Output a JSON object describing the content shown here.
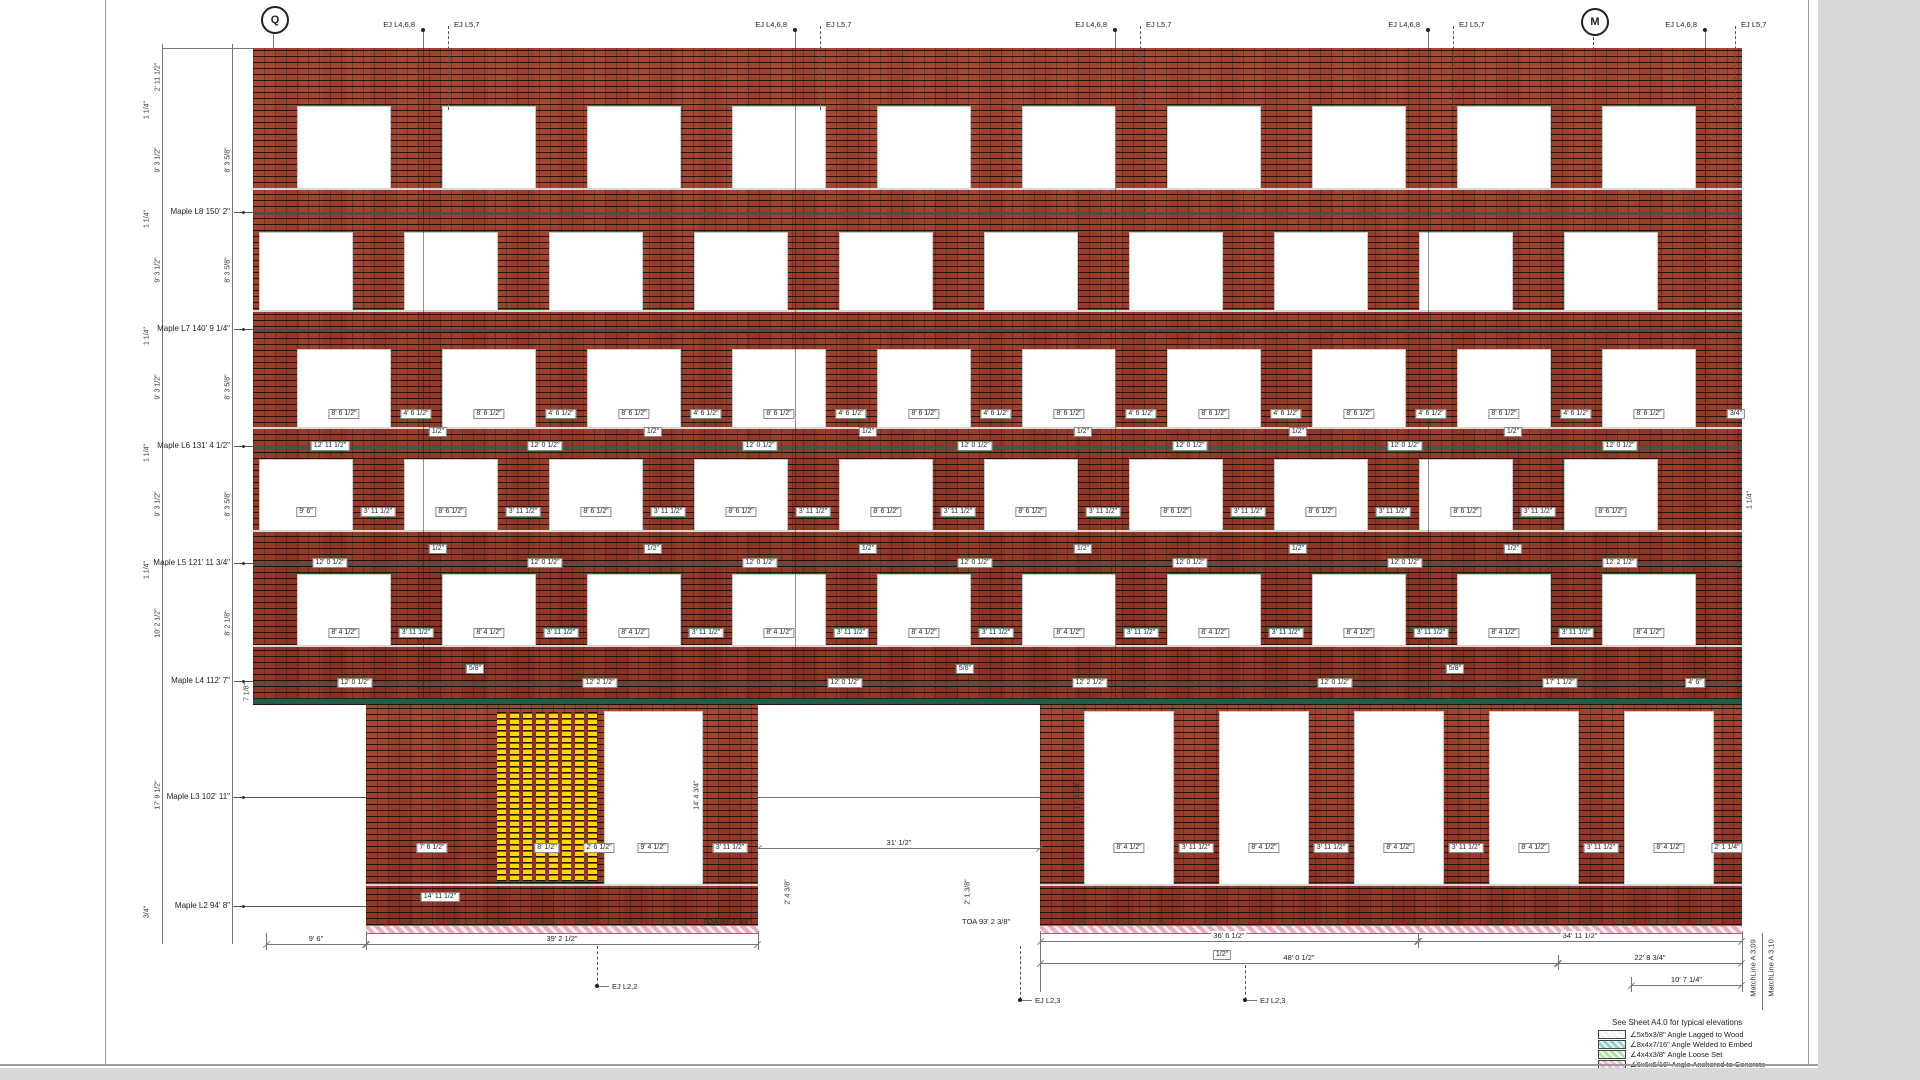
{
  "wall": {
    "x": 253,
    "w": 1489,
    "top": 48,
    "ground_top": 705,
    "ground_bottom": 925,
    "angle_lines": [
      212,
      329,
      446,
      563,
      683
    ],
    "sill_lines": [
      188,
      310,
      427,
      530,
      645
    ],
    "green_y": 698
  },
  "columns": {
    "A": {
      "start": 298,
      "pitch": 145,
      "w": 92,
      "n": 10
    },
    "B": {
      "start": 260,
      "pitch": 145,
      "w": 92,
      "n": 10
    }
  },
  "window_rows": [
    {
      "top": 107,
      "h": 81,
      "cols": "A"
    },
    {
      "top": 233,
      "h": 77,
      "cols": "B"
    },
    {
      "top": 350,
      "h": 77,
      "cols": "A"
    },
    {
      "top": 460,
      "h": 70,
      "cols": "B"
    },
    {
      "top": 575,
      "h": 70,
      "cols": "A"
    }
  ],
  "ground": {
    "massA": {
      "x": 366,
      "w": 392
    },
    "massB": {
      "x": 1040,
      "w": 702
    },
    "yellow": {
      "x": 497,
      "w": 100,
      "top": 712,
      "h": 169
    },
    "massA_window": {
      "x": 605,
      "w": 97,
      "top": 712,
      "h": 172
    },
    "massB_windows": [
      1085,
      1220,
      1355,
      1490,
      1625
    ],
    "mbw_w": 88,
    "mbw_top": 712,
    "mbw_h": 172,
    "sill_segments": [
      [
        366,
        758
      ],
      [
        1040,
        1742
      ]
    ],
    "sill_y": 884,
    "base_strips": [
      [
        366,
        758
      ],
      [
        1040,
        1742
      ]
    ],
    "base_y": 925
  },
  "grid_bubbles": [
    {
      "label": "Q",
      "x": 273,
      "y": 18
    },
    {
      "label": "M",
      "x": 1593,
      "y": 20
    }
  ],
  "ej_top": {
    "solid_label": "EJ L4,6,8",
    "dashed_label": "EJ L5,7",
    "pairs": [
      {
        "solid_x": 423,
        "dashed_x": 448
      },
      {
        "solid_x": 795,
        "dashed_x": 820
      },
      {
        "solid_x": 1115,
        "dashed_x": 1140
      },
      {
        "solid_x": 1428,
        "dashed_x": 1453
      },
      {
        "solid_x": 1705,
        "dashed_x": 1735
      }
    ]
  },
  "levels": [
    {
      "label": "Maple L8 150' 2\"",
      "y": 212,
      "leader_end": 253
    },
    {
      "label": "Maple L7 140' 9 1/4\"",
      "y": 329,
      "leader_end": 253
    },
    {
      "label": "Maple L6 131' 4 1/2\"",
      "y": 446,
      "leader_end": 253
    },
    {
      "label": "Maple L5 121' 11 3/4\"",
      "y": 563,
      "leader_end": 253
    },
    {
      "label": "Maple L4 112' 7\"",
      "y": 681,
      "leader_end": 253
    },
    {
      "label": "Maple L3 102' 11\"",
      "y": 797,
      "leader_end": 366
    },
    {
      "label": "Maple L2 94' 8\"",
      "y": 906,
      "leader_end": 366
    }
  ],
  "vdims": [
    [
      158,
      77,
      "2' 11 1/2\""
    ],
    [
      158,
      160,
      "9' 3 1/2\""
    ],
    [
      158,
      270,
      "9' 3 1/2\""
    ],
    [
      158,
      387,
      "9' 3 1/2\""
    ],
    [
      158,
      504,
      "9' 3 1/2\""
    ],
    [
      158,
      623,
      "10' 2 1/2\""
    ],
    [
      158,
      795,
      "17' 9 1/2\""
    ],
    [
      228,
      160,
      "8' 3 5/8\""
    ],
    [
      228,
      270,
      "8' 3 5/8\""
    ],
    [
      228,
      387,
      "8' 3 5/8\""
    ],
    [
      228,
      504,
      "8' 3 5/8\""
    ],
    [
      228,
      623,
      "8' 2 1/8\""
    ],
    [
      147,
      110,
      "1 1/4\""
    ],
    [
      147,
      219,
      "1 1/4\""
    ],
    [
      147,
      336,
      "1 1/4\""
    ],
    [
      147,
      453,
      "1 1/4\""
    ],
    [
      147,
      570,
      "1 1/4\""
    ],
    [
      247,
      692,
      "7 1/8\""
    ],
    [
      147,
      912,
      "3/4\""
    ],
    [
      697,
      795,
      "14' 4 3/4\""
    ],
    [
      1078,
      795,
      "17' 4 3/4\""
    ],
    [
      788,
      892,
      "2' 4 3/8\""
    ],
    [
      968,
      892,
      "2' 1 3/8\""
    ],
    [
      1750,
      500,
      "1 1/4\""
    ]
  ],
  "tags": [
    [
      344,
      414,
      "8' 6 1/2\""
    ],
    [
      489,
      414,
      "8' 6 1/2\""
    ],
    [
      634,
      414,
      "8' 6 1/2\""
    ],
    [
      779,
      414,
      "8' 6 1/2\""
    ],
    [
      924,
      414,
      "8' 6 1/2\""
    ],
    [
      1069,
      414,
      "8' 6 1/2\""
    ],
    [
      1214,
      414,
      "8' 6 1/2\""
    ],
    [
      1359,
      414,
      "8' 6 1/2\""
    ],
    [
      1504,
      414,
      "8' 6 1/2\""
    ],
    [
      1649,
      414,
      "8' 6 1/2\""
    ],
    [
      416,
      414,
      "4' 6 1/2\""
    ],
    [
      561,
      414,
      "4' 6 1/2\""
    ],
    [
      706,
      414,
      "4' 6 1/2\""
    ],
    [
      851,
      414,
      "4' 6 1/2\""
    ],
    [
      996,
      414,
      "4' 6 1/2\""
    ],
    [
      1141,
      414,
      "4' 6 1/2\""
    ],
    [
      1286,
      414,
      "4' 6 1/2\""
    ],
    [
      1431,
      414,
      "4' 6 1/2\""
    ],
    [
      1576,
      414,
      "4' 6 1/2\""
    ],
    [
      1736,
      414,
      "3/4\""
    ],
    [
      330,
      446,
      "12' 11 1/2\""
    ],
    [
      545,
      446,
      "12' 0 1/2\""
    ],
    [
      760,
      446,
      "12' 0 1/2\""
    ],
    [
      975,
      446,
      "12' 0 1/2\""
    ],
    [
      1190,
      446,
      "12' 0 1/2\""
    ],
    [
      1405,
      446,
      "12' 0 1/2\""
    ],
    [
      1620,
      446,
      "12' 0 1/2\""
    ],
    [
      438,
      432,
      "1/2\""
    ],
    [
      653,
      432,
      "1/2\""
    ],
    [
      868,
      432,
      "1/2\""
    ],
    [
      1083,
      432,
      "1/2\""
    ],
    [
      1298,
      432,
      "1/2\""
    ],
    [
      1513,
      432,
      "1/2\""
    ],
    [
      306,
      512,
      "9' 6\""
    ],
    [
      451,
      512,
      "8' 6 1/2\""
    ],
    [
      596,
      512,
      "8' 6 1/2\""
    ],
    [
      741,
      512,
      "8' 6 1/2\""
    ],
    [
      886,
      512,
      "8' 6 1/2\""
    ],
    [
      1031,
      512,
      "8' 6 1/2\""
    ],
    [
      1176,
      512,
      "8' 6 1/2\""
    ],
    [
      1321,
      512,
      "8' 6 1/2\""
    ],
    [
      1466,
      512,
      "8' 6 1/2\""
    ],
    [
      1611,
      512,
      "8' 6 1/2\""
    ],
    [
      378,
      512,
      "3' 11 1/2\""
    ],
    [
      523,
      512,
      "3' 11 1/2\""
    ],
    [
      668,
      512,
      "3' 11 1/2\""
    ],
    [
      813,
      512,
      "3' 11 1/2\""
    ],
    [
      958,
      512,
      "3' 11 1/2\""
    ],
    [
      1103,
      512,
      "3' 11 1/2\""
    ],
    [
      1248,
      512,
      "3' 11 1/2\""
    ],
    [
      1393,
      512,
      "3' 11 1/2\""
    ],
    [
      1538,
      512,
      "3' 11 1/2\""
    ],
    [
      330,
      563,
      "12' 0 1/2\""
    ],
    [
      545,
      563,
      "12' 0 1/2\""
    ],
    [
      760,
      563,
      "12' 0 1/2\""
    ],
    [
      975,
      563,
      "12' 0 1/2\""
    ],
    [
      1190,
      563,
      "12' 0 1/2\""
    ],
    [
      1405,
      563,
      "12' 0 1/2\""
    ],
    [
      1620,
      563,
      "12' 2 1/2\""
    ],
    [
      438,
      549,
      "1/2\""
    ],
    [
      653,
      549,
      "1/2\""
    ],
    [
      868,
      549,
      "1/2\""
    ],
    [
      1083,
      549,
      "1/2\""
    ],
    [
      1298,
      549,
      "1/2\""
    ],
    [
      1513,
      549,
      "1/2\""
    ],
    [
      344,
      633,
      "8' 4 1/2\""
    ],
    [
      489,
      633,
      "8' 4 1/2\""
    ],
    [
      634,
      633,
      "8' 4 1/2\""
    ],
    [
      779,
      633,
      "8' 4 1/2\""
    ],
    [
      924,
      633,
      "8' 4 1/2\""
    ],
    [
      1069,
      633,
      "8' 4 1/2\""
    ],
    [
      1214,
      633,
      "8' 4 1/2\""
    ],
    [
      1359,
      633,
      "8' 4 1/2\""
    ],
    [
      1504,
      633,
      "8' 4 1/2\""
    ],
    [
      1649,
      633,
      "8' 4 1/2\""
    ],
    [
      416,
      633,
      "3' 11 1/2\""
    ],
    [
      561,
      633,
      "3' 11 1/2\""
    ],
    [
      706,
      633,
      "3' 11 1/2\""
    ],
    [
      851,
      633,
      "3' 11 1/2\""
    ],
    [
      996,
      633,
      "3' 11 1/2\""
    ],
    [
      1141,
      633,
      "3' 11 1/2\""
    ],
    [
      1286,
      633,
      "3' 11 1/2\""
    ],
    [
      1431,
      633,
      "3' 11 1/2\""
    ],
    [
      1576,
      633,
      "3' 11 1/2\""
    ],
    [
      355,
      683,
      "12' 0 1/2\""
    ],
    [
      600,
      683,
      "12' 2 1/2\""
    ],
    [
      845,
      683,
      "12' 0 1/2\""
    ],
    [
      1090,
      683,
      "12' 2 1/2\""
    ],
    [
      1335,
      683,
      "12' 0 1/2\""
    ],
    [
      1560,
      683,
      "17' 1 1/2\""
    ],
    [
      1695,
      683,
      "4' 6\""
    ],
    [
      475,
      669,
      "5/8\""
    ],
    [
      965,
      669,
      "5/8\""
    ],
    [
      1455,
      669,
      "5/8\""
    ],
    [
      432,
      848,
      "7' 6 1/2\""
    ],
    [
      547,
      848,
      "8' 1/2\""
    ],
    [
      599,
      848,
      "2' 6 1/2\""
    ],
    [
      653,
      848,
      "9' 4 1/2\""
    ],
    [
      730,
      848,
      "3' 11 1/2\""
    ],
    [
      1129,
      848,
      "8' 4 1/2\""
    ],
    [
      1196,
      848,
      "3' 11 1/2\""
    ],
    [
      1264,
      848,
      "8' 4 1/2\""
    ],
    [
      1331,
      848,
      "3' 11 1/2\""
    ],
    [
      1399,
      848,
      "8' 4 1/2\""
    ],
    [
      1466,
      848,
      "3' 11 1/2\""
    ],
    [
      1534,
      848,
      "8' 4 1/2\""
    ],
    [
      1601,
      848,
      "3' 11 1/2\""
    ],
    [
      1669,
      848,
      "8' 4 1/2\""
    ],
    [
      1727,
      848,
      "2' 1 1/4\""
    ],
    [
      440,
      897,
      "14' 11 1/2\""
    ],
    [
      1222,
      955,
      "1/2\""
    ]
  ],
  "dimlines": [
    {
      "x1": 266,
      "x2": 366,
      "y": 944,
      "label": "9' 6\""
    },
    {
      "x1": 366,
      "x2": 758,
      "y": 944,
      "label": "39' 2 1/2\""
    },
    {
      "x1": 758,
      "x2": 1040,
      "y": 848,
      "label": "31' 1/2\""
    },
    {
      "x1": 1040,
      "x2": 1418,
      "y": 941,
      "label": "36' 6 1/2\""
    },
    {
      "x1": 1418,
      "x2": 1742,
      "y": 941,
      "label": "34' 11 1/2\""
    },
    {
      "x1": 1040,
      "x2": 1558,
      "y": 963,
      "label": "48' 0 1/2\""
    },
    {
      "x1": 1558,
      "x2": 1742,
      "y": 963,
      "label": "22' 8 3/4\""
    },
    {
      "x1": 1631,
      "x2": 1742,
      "y": 985,
      "label": "10' 7 1/4\""
    }
  ],
  "hlines": [
    [
      162,
      253,
      48
    ],
    [
      232,
      366,
      797
    ],
    [
      758,
      1040,
      797
    ],
    [
      232,
      366,
      906
    ]
  ],
  "vlines": [
    [
      162,
      44,
      944
    ],
    [
      232,
      44,
      944
    ],
    [
      266,
      933,
      950
    ],
    [
      366,
      931,
      950
    ],
    [
      758,
      931,
      950
    ],
    [
      1040,
      931,
      992
    ],
    [
      1418,
      933,
      948
    ],
    [
      1558,
      955,
      970
    ],
    [
      1631,
      977,
      992
    ],
    [
      1742,
      931,
      992
    ],
    [
      1762,
      933,
      1010
    ],
    [
      273,
      30,
      48
    ]
  ],
  "dashed_vlines": [
    [
      1593,
      32,
      50
    ],
    [
      448,
      26,
      110
    ],
    [
      820,
      26,
      110
    ],
    [
      1140,
      26,
      110
    ],
    [
      1453,
      26,
      110
    ],
    [
      1735,
      26,
      110
    ]
  ],
  "ej_verticals": [
    423,
    795,
    1115,
    1428,
    1705
  ],
  "ej_bottom": [
    {
      "x": 597,
      "y1": 946,
      "y2": 986,
      "label": "EJ L2,2"
    },
    {
      "x": 1020,
      "y1": 946,
      "y2": 1000,
      "label": "EJ L2,3"
    },
    {
      "x": 1245,
      "y1": 965,
      "y2": 1000,
      "label": "EJ L2,3"
    }
  ],
  "toa": [
    {
      "tx": 753,
      "ty": 921,
      "align": "right",
      "text": "TOA 93' 2 3/8\""
    },
    {
      "tx": 962,
      "ty": 921,
      "align": "left",
      "text": "TOA 93' 2 3/8\""
    }
  ],
  "matchlines": [
    {
      "x": 1753,
      "y": 968,
      "text": "MatchLine A 3.09"
    },
    {
      "x": 1771,
      "y": 968,
      "text": "MatchLine A 3.10"
    }
  ],
  "legend": {
    "title": "See Sheet A4.0 for typical elevations",
    "items": [
      {
        "color": "#f2f2f2",
        "label": "∠5x5x3/8\" Angle Lagged to Wood"
      },
      {
        "color": "#8fd8d2",
        "label": "∠8x4x7/16\" Angle Welded to Embed"
      },
      {
        "color": "#b5e3ab",
        "label": "∠4x4x3/8\" Angle Loose Set"
      },
      {
        "color": "#f5b9c9",
        "label": "∠6x6x5/16\" Angle Anchored to Concrete"
      }
    ]
  }
}
